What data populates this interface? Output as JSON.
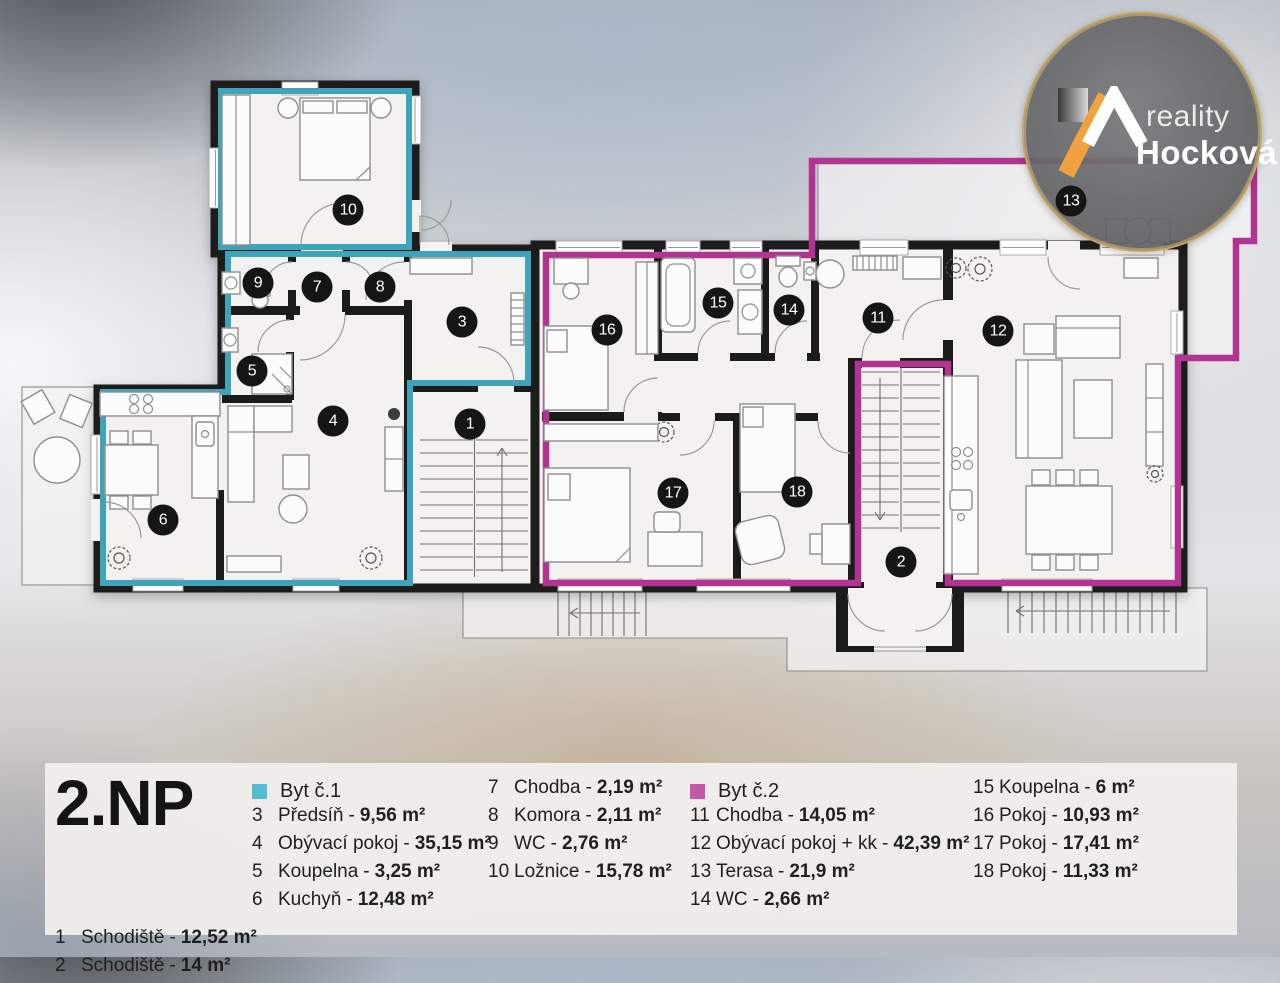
{
  "colors": {
    "byt1": "#3ea4ba",
    "byt1s": "#56bcd1",
    "byt2": "#b23491",
    "byt2s": "#c558a8",
    "wall": "#1b1b1b",
    "room": "#f3f2f1",
    "marker": "#151515",
    "gold": "#c8a45c",
    "logo_bg": "#707173",
    "orange": "#f0a23e"
  },
  "logo": {
    "brand_top": "reality",
    "brand_name": "Hocková"
  },
  "plan": {
    "markers": [
      {
        "n": "1",
        "x": 470,
        "y": 424
      },
      {
        "n": "2",
        "x": 901,
        "y": 562
      },
      {
        "n": "3",
        "x": 462,
        "y": 322
      },
      {
        "n": "4",
        "x": 333,
        "y": 421
      },
      {
        "n": "5",
        "x": 252,
        "y": 371
      },
      {
        "n": "6",
        "x": 163,
        "y": 520
      },
      {
        "n": "7",
        "x": 317,
        "y": 287
      },
      {
        "n": "8",
        "x": 380,
        "y": 287
      },
      {
        "n": "9",
        "x": 258,
        "y": 283
      },
      {
        "n": "10",
        "x": 348,
        "y": 210
      },
      {
        "n": "11",
        "x": 878,
        "y": 318
      },
      {
        "n": "12",
        "x": 998,
        "y": 331
      },
      {
        "n": "13",
        "x": 1071,
        "y": 201
      },
      {
        "n": "14",
        "x": 789,
        "y": 310
      },
      {
        "n": "15",
        "x": 718,
        "y": 303
      },
      {
        "n": "16",
        "x": 607,
        "y": 330
      },
      {
        "n": "17",
        "x": 673,
        "y": 493
      },
      {
        "n": "18",
        "x": 797,
        "y": 492
      }
    ]
  },
  "legend": {
    "title": "2.NP",
    "separator": "-",
    "common": {
      "items": [
        {
          "n": "1",
          "label": "Schodiště",
          "area": "12,52 m²"
        },
        {
          "n": "2",
          "label": "Schodiště",
          "area": "14 m²"
        }
      ]
    },
    "byt1": {
      "header": "Byt č.1",
      "items": [
        {
          "n": "3",
          "label": "Předsíň",
          "area": "9,56 m²"
        },
        {
          "n": "4",
          "label": "Obývací pokoj",
          "area": "35,15 m²"
        },
        {
          "n": "5",
          "label": "Koupelna",
          "area": "3,25 m²"
        },
        {
          "n": "6",
          "label": "Kuchyň",
          "area": "12,48 m²"
        }
      ]
    },
    "byt1_cont": {
      "items": [
        {
          "n": "7",
          "label": "Chodba",
          "area": "2,19 m²"
        },
        {
          "n": "8",
          "label": "Komora",
          "area": "2,11 m²"
        },
        {
          "n": "9",
          "label": "WC",
          "area": "2,76 m²"
        },
        {
          "n": "10",
          "label": "Ložnice",
          "area": "15,78 m²"
        }
      ]
    },
    "byt2": {
      "header": "Byt č.2",
      "items": [
        {
          "n": "11",
          "label": "Chodba",
          "area": "14,05 m²"
        },
        {
          "n": "12",
          "label": "Obývací pokoj + kk",
          "area": "42,39 m²"
        },
        {
          "n": "13",
          "label": "Terasa",
          "area": "21,9 m²"
        },
        {
          "n": "14",
          "label": "WC",
          "area": "2,66 m²"
        }
      ]
    },
    "byt2_cont": {
      "items": [
        {
          "n": "15",
          "label": "Koupelna",
          "area": "6 m²"
        },
        {
          "n": "16",
          "label": "Pokoj",
          "area": "10,93 m²"
        },
        {
          "n": "17",
          "label": "Pokoj",
          "area": "17,41 m²"
        },
        {
          "n": "18",
          "label": "Pokoj",
          "area": "11,33 m²"
        }
      ]
    }
  }
}
